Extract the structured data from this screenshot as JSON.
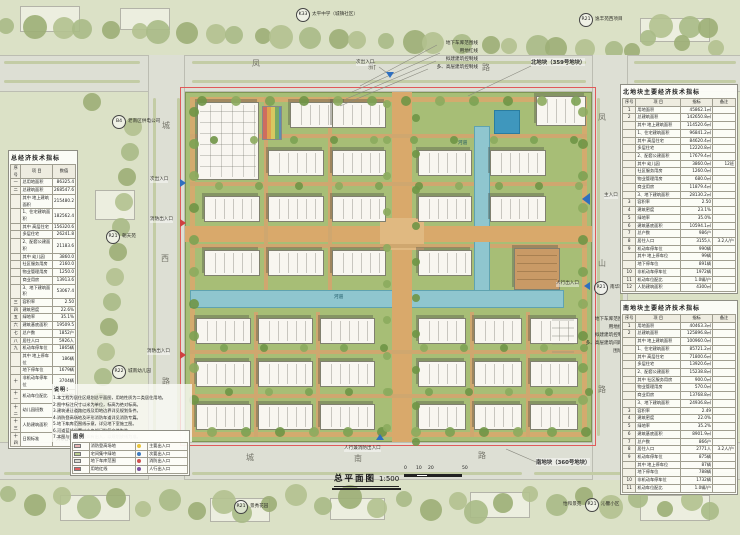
{
  "meta": {
    "drawing_title": "总平面图",
    "scale_label": "1:500",
    "scale_ticks": [
      "0",
      "10",
      "20",
      "50"
    ]
  },
  "colors": {
    "accent_red": "#e05a5a",
    "water_blue": "#8fc6cf",
    "lawn_green": "#a7be76",
    "path_tan": "#d9a96b"
  },
  "roads": {
    "top": {
      "name": "凤新路",
      "chars": [
        {
          "t": "凤",
          "x": 252,
          "y": 60
        },
        {
          "t": "新",
          "x": 368,
          "y": 63
        },
        {
          "t": "路",
          "x": 482,
          "y": 64
        }
      ]
    },
    "left": {
      "name": "城西路",
      "chars": [
        {
          "t": "城",
          "x": 162,
          "y": 122
        },
        {
          "t": "西",
          "x": 161,
          "y": 255
        },
        {
          "t": "路",
          "x": 162,
          "y": 378
        }
      ]
    },
    "right": {
      "name": "凤山路",
      "chars": [
        {
          "t": "凤",
          "x": 598,
          "y": 114
        },
        {
          "t": "山",
          "x": 598,
          "y": 260
        },
        {
          "t": "路",
          "x": 598,
          "y": 386
        }
      ]
    },
    "bottom": {
      "name": "城南路",
      "chars": [
        {
          "t": "城",
          "x": 246,
          "y": 454
        },
        {
          "t": "南",
          "x": 354,
          "y": 455
        },
        {
          "t": "路",
          "x": 478,
          "y": 452
        }
      ]
    }
  },
  "parcels": [
    {
      "text": "北地块（359号地块）",
      "x": 531,
      "y": 58
    },
    {
      "text": "南地块（360号地块）",
      "x": 536,
      "y": 458
    }
  ],
  "boundary_labels": {
    "top_group": {
      "right": 262,
      "top": 40,
      "lines": [
        "地下车库范围线",
        "用地红线",
        "拟建建筑控制线",
        "多、高层建筑控制线"
      ]
    },
    "right_group": {
      "right": 113,
      "top": 316,
      "lines": [
        "地下车库范围线",
        "用地红线",
        "拟建建筑控制线",
        "多、高层建筑间距线",
        "围墙线"
      ]
    }
  },
  "ref_circles": [
    {
      "code": "K33",
      "label": "太平中学（城镇社区）",
      "cx": 303,
      "cy": 15
    },
    {
      "code": "R21",
      "label": "逸丰苑西项目",
      "cx": 586,
      "cy": 20
    },
    {
      "code": "B4",
      "label": "老南区供电公司",
      "cx": 119,
      "cy": 122
    },
    {
      "code": "R21",
      "label": "朝天苑",
      "cx": 113,
      "cy": 237
    },
    {
      "code": "R22",
      "label": "城南幼儿园",
      "cx": 119,
      "cy": 372
    },
    {
      "code": "R21",
      "label": "景秀花园",
      "cx": 241,
      "cy": 507
    },
    {
      "code": "R21",
      "label": "沁馨小区",
      "pre": "怡和景苑",
      "cx": 592,
      "cy": 505
    },
    {
      "code": "R21",
      "label": "南华雅苑",
      "cx": 601,
      "cy": 288
    }
  ],
  "entrances": [
    {
      "label": "次出入口",
      "tx": 356,
      "ty": 61,
      "mx": 390,
      "my": 76,
      "dir": "down",
      "fire": false,
      "big": false
    },
    {
      "label": "次出入口",
      "tx": 150,
      "ty": 178,
      "mx": 184,
      "my": 183,
      "dir": "right",
      "fire": false,
      "big": false
    },
    {
      "label": "消防出入口",
      "tx": 150,
      "ty": 218,
      "mx": 184,
      "my": 223,
      "dir": "right",
      "fire": true,
      "big": false
    },
    {
      "label": "消防出入口",
      "tx": 147,
      "ty": 350,
      "mx": 184,
      "my": 355,
      "dir": "right",
      "fire": true,
      "big": false
    },
    {
      "label": "主入口",
      "tx": 604,
      "ty": 194,
      "mx": 588,
      "my": 199,
      "dir": "left",
      "fire": false,
      "big": true
    },
    {
      "label": "人行出入口",
      "tx": 556,
      "ty": 282,
      "mx": 588,
      "my": 286,
      "dir": "left",
      "fire": false,
      "big": false
    },
    {
      "label": "人行兼消防出入口",
      "tx": 344,
      "ty": 447,
      "mx": 380,
      "my": 438,
      "dir": "up",
      "fire": false,
      "big": false
    }
  ],
  "plan": {
    "water_labels": [
      {
        "t": "河道",
        "x": 458,
        "y": 140
      },
      {
        "t": "河道",
        "x": 334,
        "y": 294
      }
    ],
    "water": {
      "v": {
        "x": 474,
        "y": 126,
        "w": 16,
        "h": 172
      },
      "h": {
        "x": 190,
        "y": 290,
        "w": 374,
        "h": 18
      },
      "pool": {
        "x": 494,
        "y": 110,
        "w": 26,
        "h": 24
      }
    },
    "buildings": [
      {
        "x": 197,
        "y": 102,
        "w": 62,
        "h": 78,
        "t": "kinder"
      },
      {
        "x": 262,
        "y": 106,
        "w": 20,
        "h": 34,
        "t": "stripes"
      },
      {
        "x": 290,
        "y": 102,
        "w": 56,
        "h": 26,
        "t": "slab"
      },
      {
        "x": 332,
        "y": 102,
        "w": 54,
        "h": 26,
        "t": "slab"
      },
      {
        "x": 536,
        "y": 96,
        "w": 50,
        "h": 30,
        "t": "slab"
      },
      {
        "x": 268,
        "y": 150,
        "w": 56,
        "h": 26,
        "t": "slab"
      },
      {
        "x": 332,
        "y": 150,
        "w": 54,
        "h": 26,
        "t": "slab"
      },
      {
        "x": 418,
        "y": 150,
        "w": 54,
        "h": 26,
        "t": "slab"
      },
      {
        "x": 490,
        "y": 150,
        "w": 56,
        "h": 26,
        "t": "slab"
      },
      {
        "x": 204,
        "y": 196,
        "w": 56,
        "h": 26,
        "t": "slab"
      },
      {
        "x": 268,
        "y": 196,
        "w": 56,
        "h": 26,
        "t": "slab"
      },
      {
        "x": 332,
        "y": 196,
        "w": 54,
        "h": 26,
        "t": "slab"
      },
      {
        "x": 418,
        "y": 196,
        "w": 54,
        "h": 26,
        "t": "slab"
      },
      {
        "x": 490,
        "y": 196,
        "w": 56,
        "h": 26,
        "t": "slab"
      },
      {
        "x": 204,
        "y": 250,
        "w": 56,
        "h": 26,
        "t": "slab"
      },
      {
        "x": 268,
        "y": 250,
        "w": 56,
        "h": 26,
        "t": "slab"
      },
      {
        "x": 332,
        "y": 250,
        "w": 54,
        "h": 26,
        "t": "slab"
      },
      {
        "x": 418,
        "y": 250,
        "w": 54,
        "h": 26,
        "t": "slab"
      },
      {
        "x": 514,
        "y": 248,
        "w": 46,
        "h": 42,
        "t": "podium"
      },
      {
        "x": 196,
        "y": 318,
        "w": 55,
        "h": 26,
        "t": "slab"
      },
      {
        "x": 258,
        "y": 318,
        "w": 55,
        "h": 26,
        "t": "slab"
      },
      {
        "x": 320,
        "y": 318,
        "w": 55,
        "h": 26,
        "t": "slab"
      },
      {
        "x": 418,
        "y": 318,
        "w": 48,
        "h": 26,
        "t": "slab"
      },
      {
        "x": 474,
        "y": 318,
        "w": 48,
        "h": 26,
        "t": "slab"
      },
      {
        "x": 530,
        "y": 318,
        "w": 48,
        "h": 26,
        "t": "slab"
      },
      {
        "x": 196,
        "y": 361,
        "w": 55,
        "h": 26,
        "t": "slab"
      },
      {
        "x": 258,
        "y": 361,
        "w": 55,
        "h": 26,
        "t": "slab"
      },
      {
        "x": 320,
        "y": 361,
        "w": 55,
        "h": 26,
        "t": "slab"
      },
      {
        "x": 418,
        "y": 361,
        "w": 48,
        "h": 26,
        "t": "slab"
      },
      {
        "x": 474,
        "y": 361,
        "w": 48,
        "h": 26,
        "t": "slab"
      },
      {
        "x": 530,
        "y": 361,
        "w": 48,
        "h": 26,
        "t": "slab"
      },
      {
        "x": 196,
        "y": 404,
        "w": 55,
        "h": 26,
        "t": "slab"
      },
      {
        "x": 258,
        "y": 404,
        "w": 55,
        "h": 26,
        "t": "slab"
      },
      {
        "x": 320,
        "y": 404,
        "w": 55,
        "h": 26,
        "t": "slab"
      },
      {
        "x": 418,
        "y": 404,
        "w": 48,
        "h": 26,
        "t": "slab"
      },
      {
        "x": 474,
        "y": 404,
        "w": 48,
        "h": 26,
        "t": "slab"
      },
      {
        "x": 530,
        "y": 404,
        "w": 48,
        "h": 26,
        "t": "slab"
      }
    ]
  },
  "left_table": {
    "title": "总经济技术指标",
    "header": [
      "序号",
      "项  目",
      "数值"
    ],
    "rows": [
      [
        "一",
        "总用地面积",
        "86325.4"
      ],
      [
        "二",
        "总建筑面积",
        "268547.6"
      ],
      [
        "",
        "其中 地上建筑面积",
        "215480.2"
      ],
      [
        "",
        "1、住宅建筑面积",
        "182562.4"
      ],
      [
        "",
        "其中 高层住宅",
        "156320.6"
      ],
      [
        "",
        "多层住宅",
        "26241.8"
      ],
      [
        "",
        "2、配套公建面积",
        "21183.6"
      ],
      [
        "",
        "其中 幼儿园",
        "3860.0"
      ],
      [
        "",
        "社区服务用房",
        "2160.0"
      ],
      [
        "",
        "物业管理用房",
        "1250.0"
      ],
      [
        "",
        "商业用房",
        "13913.6"
      ],
      [
        "",
        "3、地下建筑面积",
        "53067.4"
      ],
      [
        "三",
        "容积率",
        "2.50"
      ],
      [
        "四",
        "建筑密度",
        "22.6%"
      ],
      [
        "五",
        "绿地率",
        "35.1%"
      ],
      [
        "六",
        "建筑基底面积",
        "19509.5"
      ],
      [
        "七",
        "总户数",
        "1852户"
      ],
      [
        "八",
        "居住人口",
        "5926人"
      ],
      [
        "九",
        "机动车停车位",
        "1865辆"
      ],
      [
        "",
        "其中 地上停车位",
        "186辆"
      ],
      [
        "",
        "地下停车位",
        "1679辆"
      ],
      [
        "十",
        "非机动车停车位",
        "3704辆"
      ],
      [
        "十一",
        "机动车位配比",
        "1.0辆/户"
      ],
      [
        "十二",
        "幼儿园班数",
        "12班"
      ],
      [
        "十三",
        "人防建筑面积",
        "8650"
      ],
      [
        "十四",
        "日照标准",
        "大寒日2h"
      ]
    ]
  },
  "right_tables": [
    {
      "title": "北地块主要经济技术指标",
      "header": [
        "序号",
        "项  目",
        "指标",
        "备注"
      ],
      "rows": [
        [
          "1",
          "用地面积",
          "45862.1㎡",
          ""
        ],
        [
          "2",
          "总建筑面积",
          "142650.8㎡",
          ""
        ],
        [
          "",
          "其中 地上建筑面积",
          "114520.6㎡",
          ""
        ],
        [
          "",
          "1、住宅建筑面积",
          "96841.2㎡",
          ""
        ],
        [
          "",
          "其中 高层住宅",
          "84620.4㎡",
          ""
        ],
        [
          "",
          "多层住宅",
          "12220.8㎡",
          ""
        ],
        [
          "",
          "2、配套公建面积",
          "17679.4㎡",
          ""
        ],
        [
          "",
          "其中 幼儿园",
          "3860.0㎡",
          "12班"
        ],
        [
          "",
          "社区服务用房",
          "1260.0㎡",
          ""
        ],
        [
          "",
          "物业管理用房",
          "680.0㎡",
          ""
        ],
        [
          "",
          "商业用房",
          "11879.4㎡",
          ""
        ],
        [
          "",
          "3、地下建筑面积",
          "28130.2㎡",
          ""
        ],
        [
          "3",
          "容积率",
          "2.50",
          ""
        ],
        [
          "4",
          "建筑密度",
          "23.1%",
          ""
        ],
        [
          "5",
          "绿地率",
          "35.0%",
          ""
        ],
        [
          "6",
          "建筑基底面积",
          "10594.1㎡",
          ""
        ],
        [
          "7",
          "总户数",
          "986户",
          ""
        ],
        [
          "8",
          "居住人口",
          "3155人",
          "3.2人/户"
        ],
        [
          "9",
          "机动车停车位",
          "990辆",
          ""
        ],
        [
          "",
          "其中 地上停车位",
          "99辆",
          ""
        ],
        [
          "",
          "地下停车位",
          "891辆",
          ""
        ],
        [
          "10",
          "非机动车停车位",
          "1972辆",
          ""
        ],
        [
          "11",
          "机动车位配比",
          "1.0辆/户",
          ""
        ],
        [
          "12",
          "人防建筑面积",
          "4300㎡",
          ""
        ]
      ]
    },
    {
      "title": "南地块主要经济技术指标",
      "header": [
        "序号",
        "项  目",
        "指标",
        "备注"
      ],
      "rows": [
        [
          "1",
          "用地面积",
          "40463.3㎡",
          ""
        ],
        [
          "2",
          "总建筑面积",
          "125896.8㎡",
          ""
        ],
        [
          "",
          "其中 地上建筑面积",
          "100960.0㎡",
          ""
        ],
        [
          "",
          "1、住宅建筑面积",
          "85721.2㎡",
          ""
        ],
        [
          "",
          "其中 高层住宅",
          "71800.6㎡",
          ""
        ],
        [
          "",
          "多层住宅",
          "13920.6㎡",
          ""
        ],
        [
          "",
          "2、配套公建面积",
          "15238.8㎡",
          ""
        ],
        [
          "",
          "其中 社区服务用房",
          "900.0㎡",
          ""
        ],
        [
          "",
          "物业管理用房",
          "570.0㎡",
          ""
        ],
        [
          "",
          "商业用房",
          "13768.8㎡",
          ""
        ],
        [
          "",
          "3、地下建筑面积",
          "24936.8㎡",
          ""
        ],
        [
          "3",
          "容积率",
          "2.49",
          ""
        ],
        [
          "4",
          "建筑密度",
          "22.0%",
          ""
        ],
        [
          "5",
          "绿地率",
          "35.2%",
          ""
        ],
        [
          "6",
          "建筑基底面积",
          "8901.9㎡",
          ""
        ],
        [
          "7",
          "总户数",
          "866户",
          ""
        ],
        [
          "8",
          "居住人口",
          "2771人",
          "3.2人/户"
        ],
        [
          "9",
          "机动车停车位",
          "875辆",
          ""
        ],
        [
          "",
          "其中 地上停车位",
          "87辆",
          ""
        ],
        [
          "",
          "地下停车位",
          "788辆",
          ""
        ],
        [
          "10",
          "非机动车停车位",
          "1732辆",
          ""
        ],
        [
          "11",
          "机动车位配比",
          "1.0辆/户",
          ""
        ]
      ]
    }
  ],
  "notes": {
    "title": "说明：",
    "lines": [
      "1.本工程为居住区规划总平面图，用地性质为二类居住用地。",
      "2.图中标注尺寸以米为单位，标高为绝对标高。",
      "3.建筑退让道路红线及用地边界详见规划条件。",
      "4.消防登高场地及环形消防车道详见消防专篇。",
      "5.地下车库范围线示意，详见地下室施工图。",
      "6.河道蓝线位置以水务部门批复文件为准。",
      "7.本图与实际放线如有出入，以规划放线为准。"
    ]
  },
  "legend": {
    "title": "图例",
    "rows": [
      {
        "swatch": "#e8b6b6",
        "sl": "消防登高场地",
        "dot": "#e8c43c",
        "dl": "主要出入口"
      },
      {
        "swatch": "#b9cc8e",
        "sl": "宅间集中绿地",
        "dot": "#3e7bc0",
        "dl": "次要出入口"
      },
      {
        "swatch": "#d9d9d0",
        "sl": "地下车库范围",
        "dot": "#d05050",
        "dl": "消防出入口"
      },
      {
        "swatch": "#e06060",
        "sl": "用地红线",
        "dot": "#7a52a0",
        "dl": "人行出入口"
      }
    ]
  }
}
